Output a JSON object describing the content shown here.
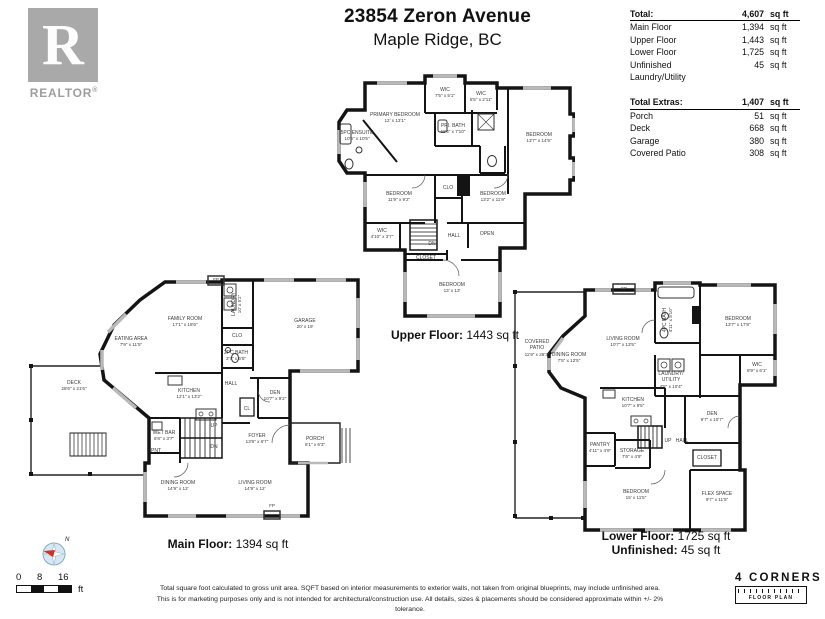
{
  "header": {
    "address": "23854 Zeron Avenue",
    "city": "Maple Ridge, BC"
  },
  "branding": {
    "realtor_r": "R",
    "realtor_text": "REALTOR",
    "registered_mark": "®",
    "logo_name": "4 CORNERS",
    "logo_sub": "FLOOR PLAN"
  },
  "area_table": {
    "total": {
      "label": "Total:",
      "value": "4,607",
      "unit": "sq ft"
    },
    "rows": [
      {
        "label": "Main Floor",
        "value": "1,394",
        "unit": "sq ft"
      },
      {
        "label": "Upper Floor",
        "value": "1,443",
        "unit": "sq ft"
      },
      {
        "label": "Lower Floor",
        "value": "1,725",
        "unit": "sq ft"
      },
      {
        "label": "Unfinished Laundry/Utility",
        "value": "45",
        "unit": "sq ft"
      }
    ],
    "extras_total": {
      "label": "Total Extras:",
      "value": "1,407",
      "unit": "sq ft"
    },
    "extras_rows": [
      {
        "label": "Porch",
        "value": "51",
        "unit": "sq ft"
      },
      {
        "label": "Deck",
        "value": "668",
        "unit": "sq ft"
      },
      {
        "label": "Garage",
        "value": "380",
        "unit": "sq ft"
      },
      {
        "label": "Covered Patio",
        "value": "308",
        "unit": "sq ft"
      }
    ]
  },
  "plans": {
    "upper": {
      "caption_label": "Upper Floor:",
      "caption_value": "1443 sq ft",
      "rooms": {
        "primary_bedroom": {
          "name": "PRIMARY BEDROOM",
          "dims": "12' x 13'1\""
        },
        "wic1": {
          "name": "WIC",
          "dims": "7'5\" x 5'1\""
        },
        "wic2": {
          "name": "WIC",
          "dims": "5'5\" x 2'11\""
        },
        "pri_bath": {
          "name": "PRI. BATH",
          "dims": "11'4\" x 7'10\""
        },
        "ensuite": {
          "name": "5PC ENSUITE",
          "dims": "10'6\" x 10'5\""
        },
        "bedroom_right": {
          "name": "BEDROOM",
          "dims": "13'7\" x 14'9\""
        },
        "bedroom_left": {
          "name": "BEDROOM",
          "dims": "11'9\" x 9'2\""
        },
        "clo": {
          "name": "CLO"
        },
        "bedroom_mid": {
          "name": "BEDROOM",
          "dims": "13'2\" x 11'9\""
        },
        "wic3": {
          "name": "WIC",
          "dims": "4'10\" x 3'7\""
        },
        "dn": {
          "name": "DN"
        },
        "hall": {
          "name": "HALL"
        },
        "open": {
          "name": "OPEN"
        },
        "closet": {
          "name": "CLOSET"
        },
        "bedroom_bottom": {
          "name": "BEDROOM",
          "dims": "13' x 13'"
        }
      }
    },
    "main": {
      "caption_label": "Main Floor:",
      "caption_value": "1394 sq ft",
      "rooms": {
        "family_room": {
          "name": "FAMILY ROOM",
          "dims": "17'1\" x 18'6\""
        },
        "eating_area": {
          "name": "EATING AREA",
          "dims": "7'9\" x 11'5\""
        },
        "laundry": {
          "name": "LAUNDRY",
          "dims": "10' x 5'2\""
        },
        "clo": {
          "name": "CLO"
        },
        "bath_2pc": {
          "name": "2PC BATH",
          "dims": "3'7\" x 6'5\""
        },
        "hall": {
          "name": "HALL"
        },
        "cl": {
          "name": "CL"
        },
        "garage": {
          "name": "GARAGE",
          "dims": "20' x 19'"
        },
        "deck": {
          "name": "DECK",
          "dims": "28'6\" x 21'6\""
        },
        "kitchen": {
          "name": "KITCHEN",
          "dims": "12'1\" x 13'2\""
        },
        "wet_bar": {
          "name": "WET BAR",
          "dims": "6'8\" x 3'7\""
        },
        "pnt": {
          "name": "PNT"
        },
        "up": {
          "name": "UP"
        },
        "dn": {
          "name": "DN"
        },
        "den": {
          "name": "DEN",
          "dims": "10'7\" x 9'2\""
        },
        "foyer": {
          "name": "FOYER",
          "dims": "13'6\" x 6'7\""
        },
        "porch": {
          "name": "PORCH",
          "dims": "8'1\" x 6'3\""
        },
        "dining_room": {
          "name": "DINING ROOM",
          "dims": "14'9\" x 12'"
        },
        "living_room": {
          "name": "LIVING ROOM",
          "dims": "14'9\" x 12'"
        },
        "fp_top": {
          "name": "FP"
        },
        "fp_bottom": {
          "name": "FP"
        }
      }
    },
    "lower": {
      "caption_label": "Lower Floor:",
      "caption_value": "1725 sq ft",
      "caption2_label": "Unfinished:",
      "caption2_value": "45 sq ft",
      "rooms": {
        "covered_patio": {
          "name": "COVERED PATIO",
          "dims": "11'9\" x 26'3\""
        },
        "dining_room": {
          "name": "DINING ROOM",
          "dims": "7'5\" x 12'5\""
        },
        "living_room": {
          "name": "LIVING ROOM",
          "dims": "10'7\" x 13'5\""
        },
        "bath_4pc": {
          "name": "4PC BATH",
          "dims": "4'11\" x 8'10\""
        },
        "bedroom_top": {
          "name": "BEDROOM",
          "dims": "13'7\" x 17'8\""
        },
        "wic": {
          "name": "WIC",
          "dims": "8'9\" x 6'1\""
        },
        "laundry_utility": {
          "name": "LAUNDRY/ UTILITY",
          "dims": "4'5\" x 10'4\""
        },
        "fp": {
          "name": "FP"
        },
        "kitchen": {
          "name": "KITCHEN",
          "dims": "10'7\" x 9'5\""
        },
        "den": {
          "name": "DEN",
          "dims": "9'7\" x 10'7\""
        },
        "pantry": {
          "name": "PANTRY",
          "dims": "4'11\" x 4'9\""
        },
        "storage": {
          "name": "STORAGE",
          "dims": "7'6\" x 4'9\""
        },
        "up": {
          "name": "UP"
        },
        "hall": {
          "name": "HALL"
        },
        "closet": {
          "name": "CLOSET"
        },
        "bedroom_bottom": {
          "name": "BEDROOM",
          "dims": "15' x 11'5\""
        },
        "flex_space": {
          "name": "FLEX SPACE",
          "dims": "9'7\" x 11'5\""
        }
      }
    }
  },
  "footer": {
    "compass_n": "N",
    "scale": {
      "t0": "0",
      "t8": "8",
      "t16": "16",
      "unit": "ft"
    },
    "disclaimer_line1": "Total square foot calculated to gross unit area. SQFT based on interior measurements to exterior walls, not taken from original blueprints, may include unfinished area.",
    "disclaimer_line2": "This is for marketing purposes only and is not intended for architectural/construction use.  All details, sizes & placements should be considered approximate within +/- 2%  tolerance."
  }
}
